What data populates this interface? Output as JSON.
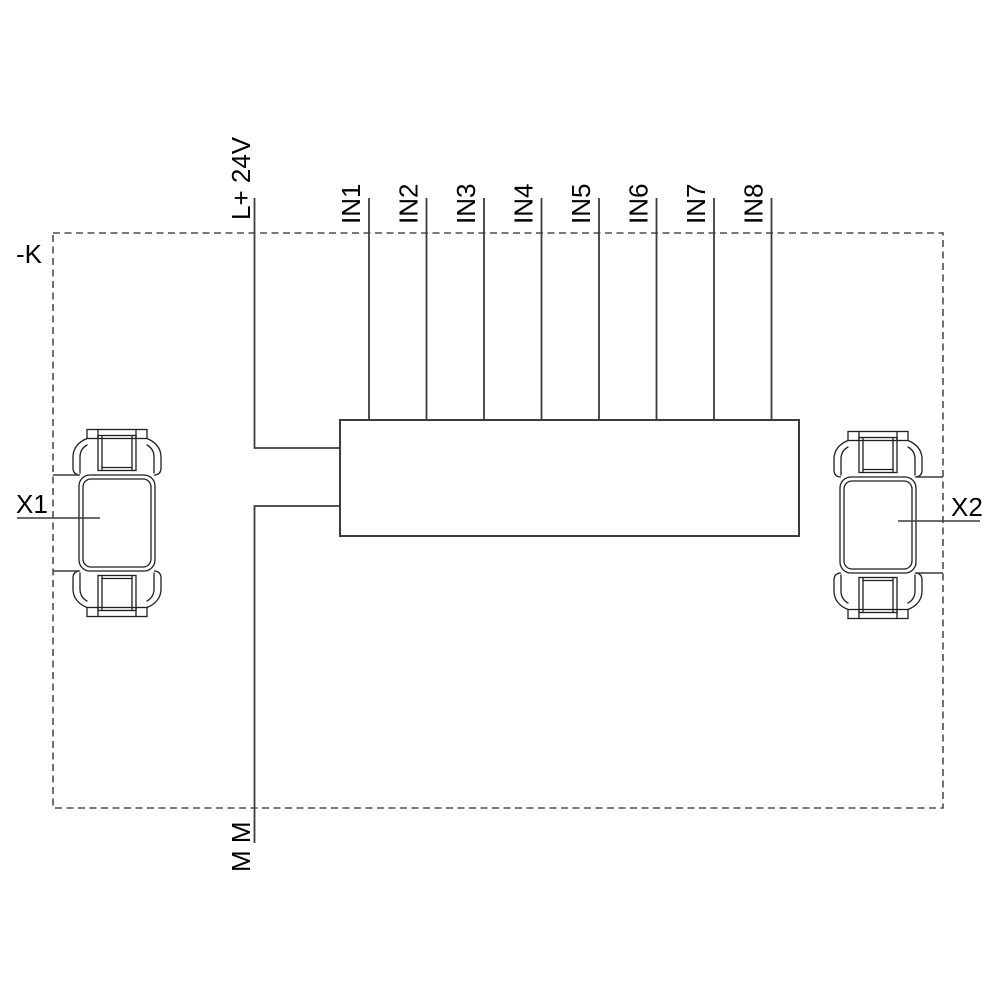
{
  "diagram": {
    "module_label": "-K",
    "power_label": "L+ 24V",
    "ground_label": "M M",
    "input_labels": [
      "IN1",
      "IN2",
      "IN3",
      "IN4",
      "IN5",
      "IN6",
      "IN7",
      "IN8"
    ],
    "connectors": {
      "left": "X1",
      "right": "X2"
    },
    "colors": {
      "background": "#ffffff",
      "wire": "#3c3c3c",
      "boundary": "#4f4f4f",
      "symbol_outline": "#1f1f1f",
      "text": "#000000"
    }
  }
}
